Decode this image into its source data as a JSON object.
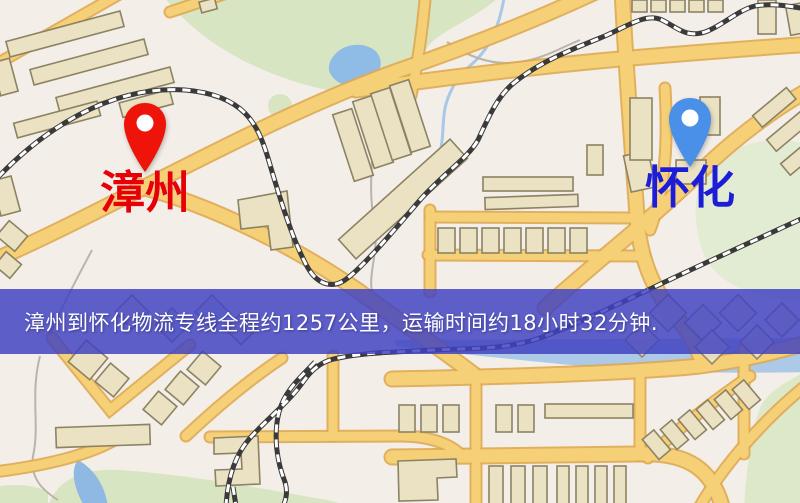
{
  "page": {
    "width": 800,
    "height": 503,
    "kind": "logistics route map image"
  },
  "banner": {
    "text": "漳州到怀化物流专线全程约1257公里，运输时间约18小时32分钟.",
    "origin": "漳州",
    "destination": "怀化",
    "distance": "1257公里",
    "duration": "18小时32分钟",
    "bg_color": "rgba(64,66,193,0.84)",
    "text_color": "#ffffff"
  },
  "markers": [
    {
      "id": "origin",
      "label": "漳州",
      "pin_color": "#ee1409",
      "label_color": "#e60008",
      "x": 115,
      "y": 97
    },
    {
      "id": "destination",
      "label": "怀化",
      "pin_color": "#4a90e8",
      "label_color": "#1d1dd6",
      "x": 660,
      "y": 92
    }
  ],
  "map": {
    "style": "cartoon street map",
    "colors": {
      "background": "#f3eee7",
      "road_fill": "#f6d077",
      "road_casing": "#dfa850",
      "building_fill": "#ebe1c3",
      "building_stroke": "#8c8264",
      "park": "#d8e5c3",
      "park_light": "#e4eed6",
      "water": "#96bfe7",
      "railway_dark": "#3a3a3a",
      "railway_light": "#ffffff"
    }
  }
}
